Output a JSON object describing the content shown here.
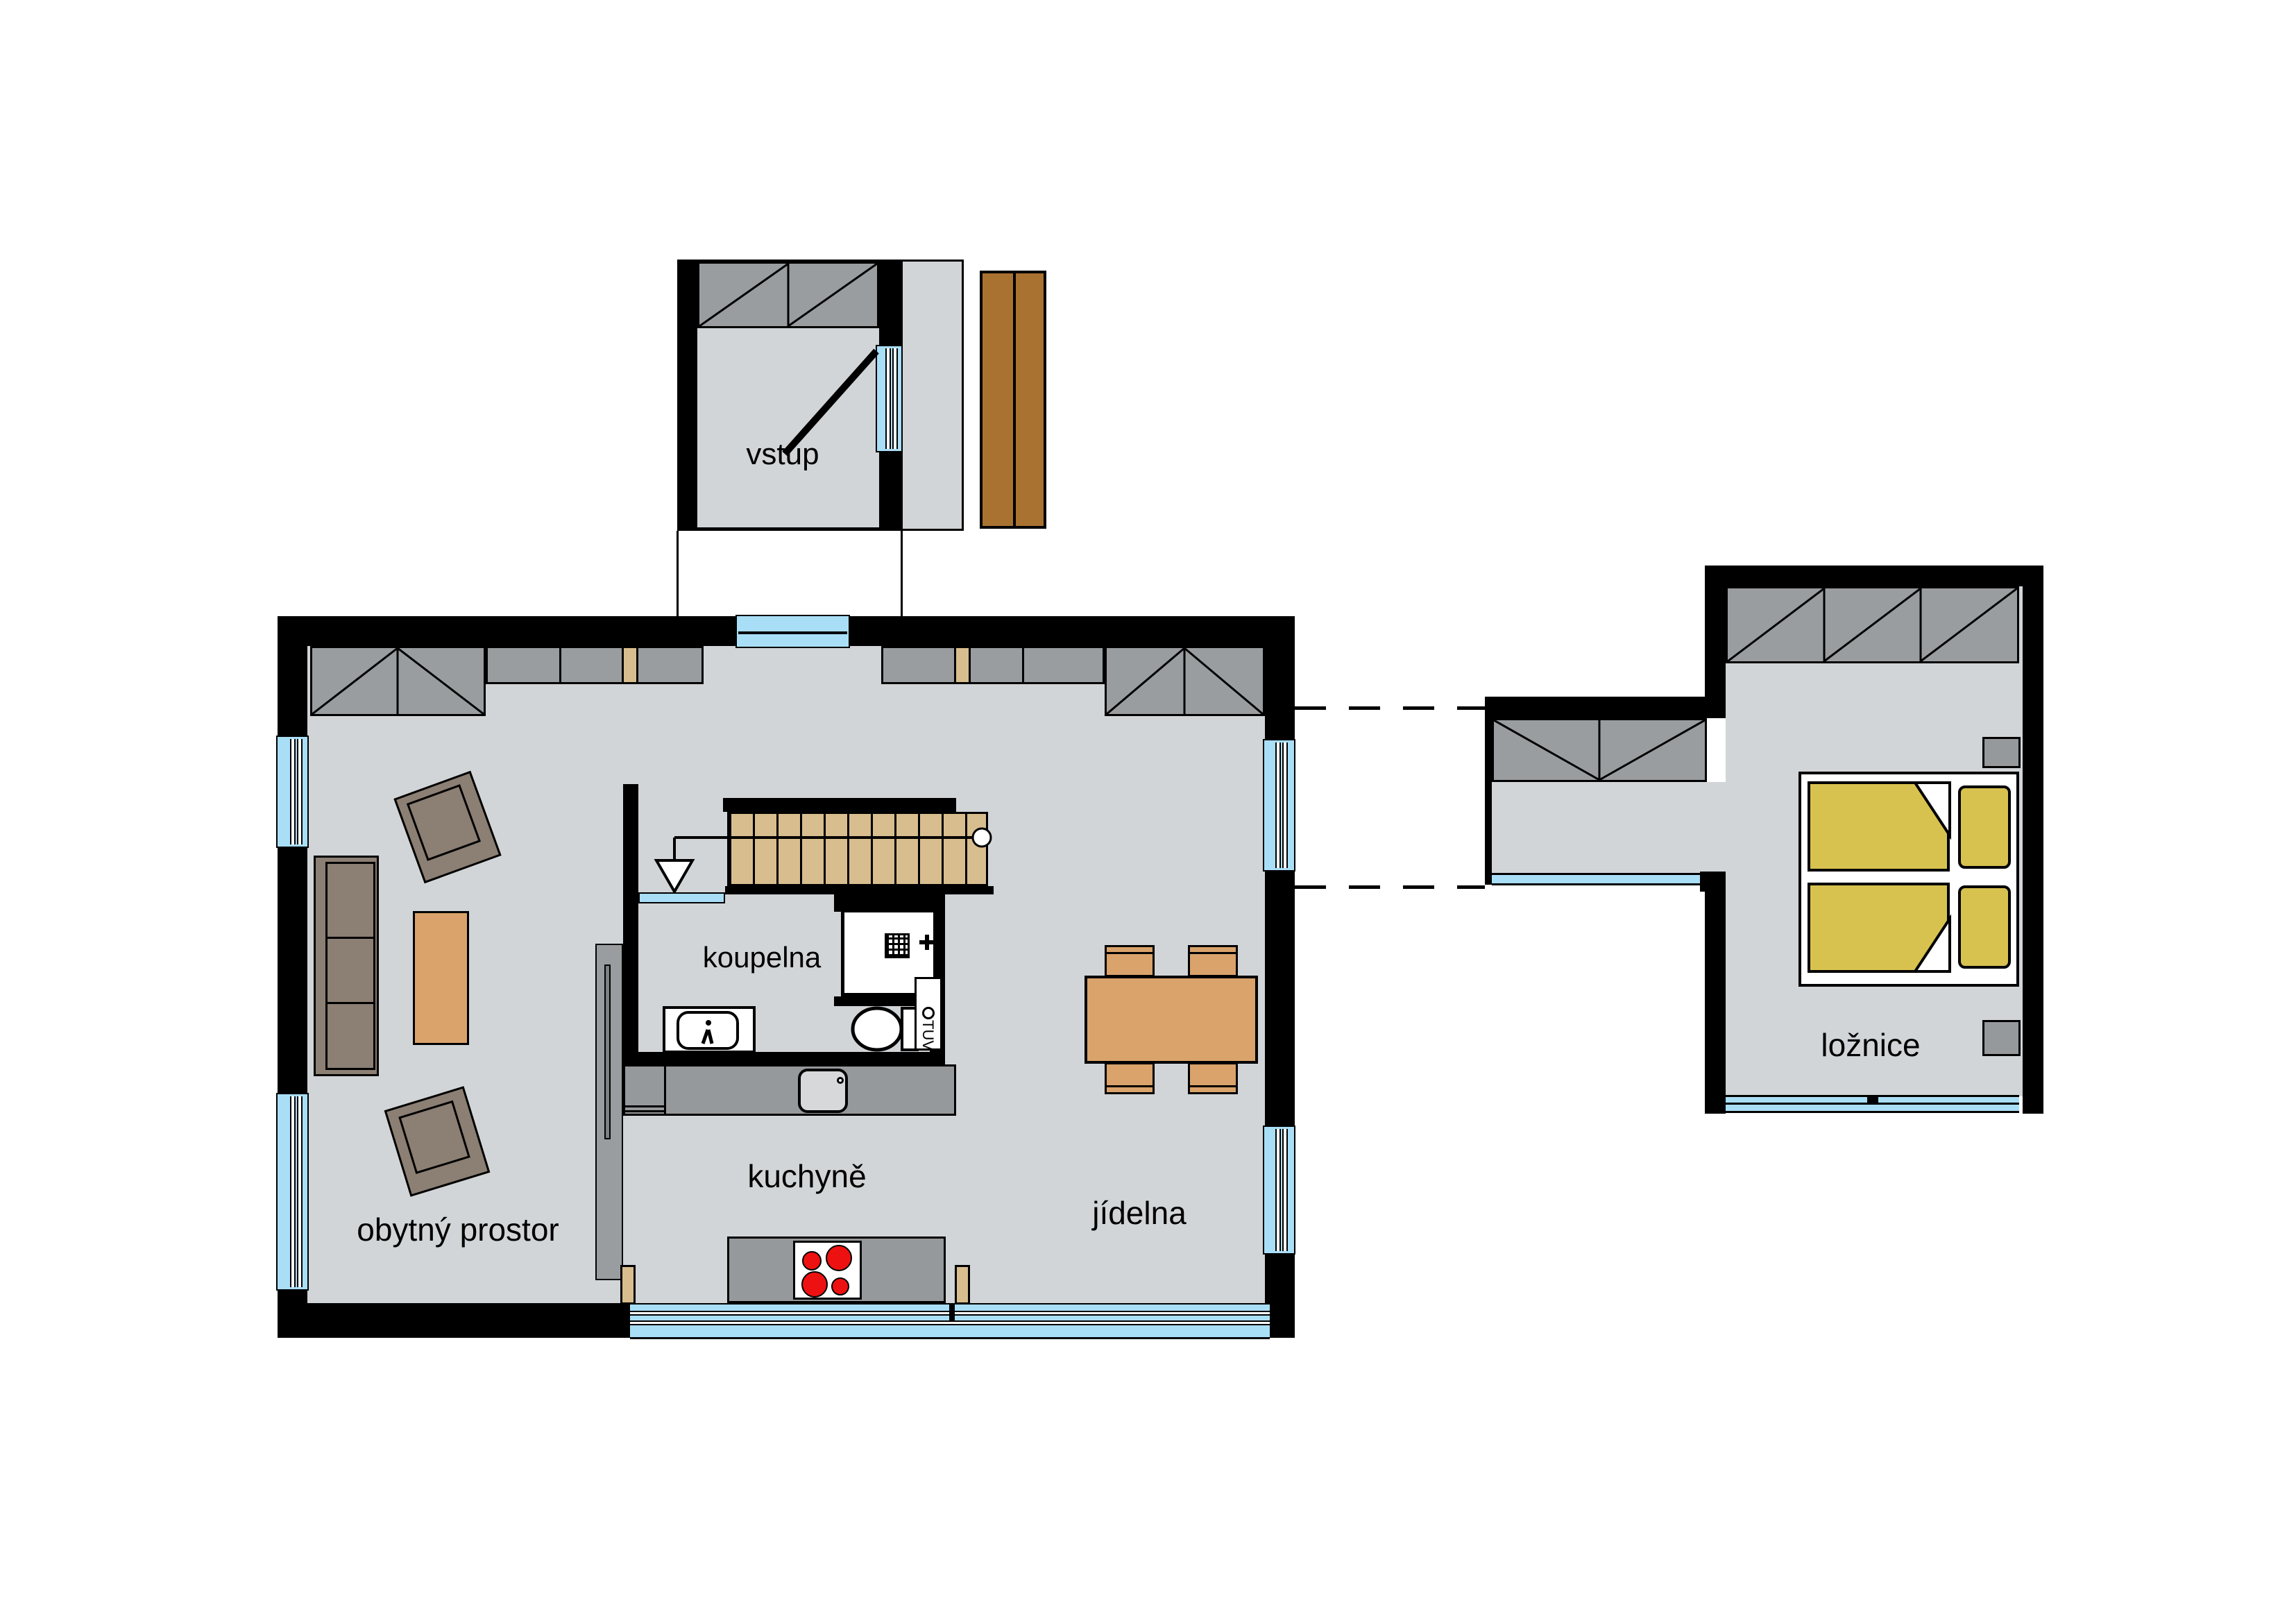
{
  "document": {
    "type": "floor-plan",
    "language": "cs",
    "description": "single family house ground floor plan"
  },
  "rooms": {
    "entrance": {
      "label": "vstup"
    },
    "bathroom": {
      "label": "koupelna"
    },
    "kitchen": {
      "label": "kuchyně"
    },
    "dining": {
      "label": "jídelna"
    },
    "living": {
      "label": "obytný prostor"
    },
    "bedroom": {
      "label": "ložnice"
    }
  },
  "equipment": {
    "water_heater": {
      "label": "TUV"
    }
  },
  "colors": {
    "wall": "#000000",
    "floor": "#d2d5d7",
    "furniture_gray": "#9a9da0",
    "counter_gray": "#96999c",
    "stairs_tan": "#d8bd8e",
    "door_mat_wood": "#a97231",
    "table_wood": "#d9a36b",
    "sofa_brown": "#8c7f73",
    "bed_yellow": "#d8c24f",
    "window_blue": "#a9def7",
    "burner_red": "#ee1111"
  }
}
